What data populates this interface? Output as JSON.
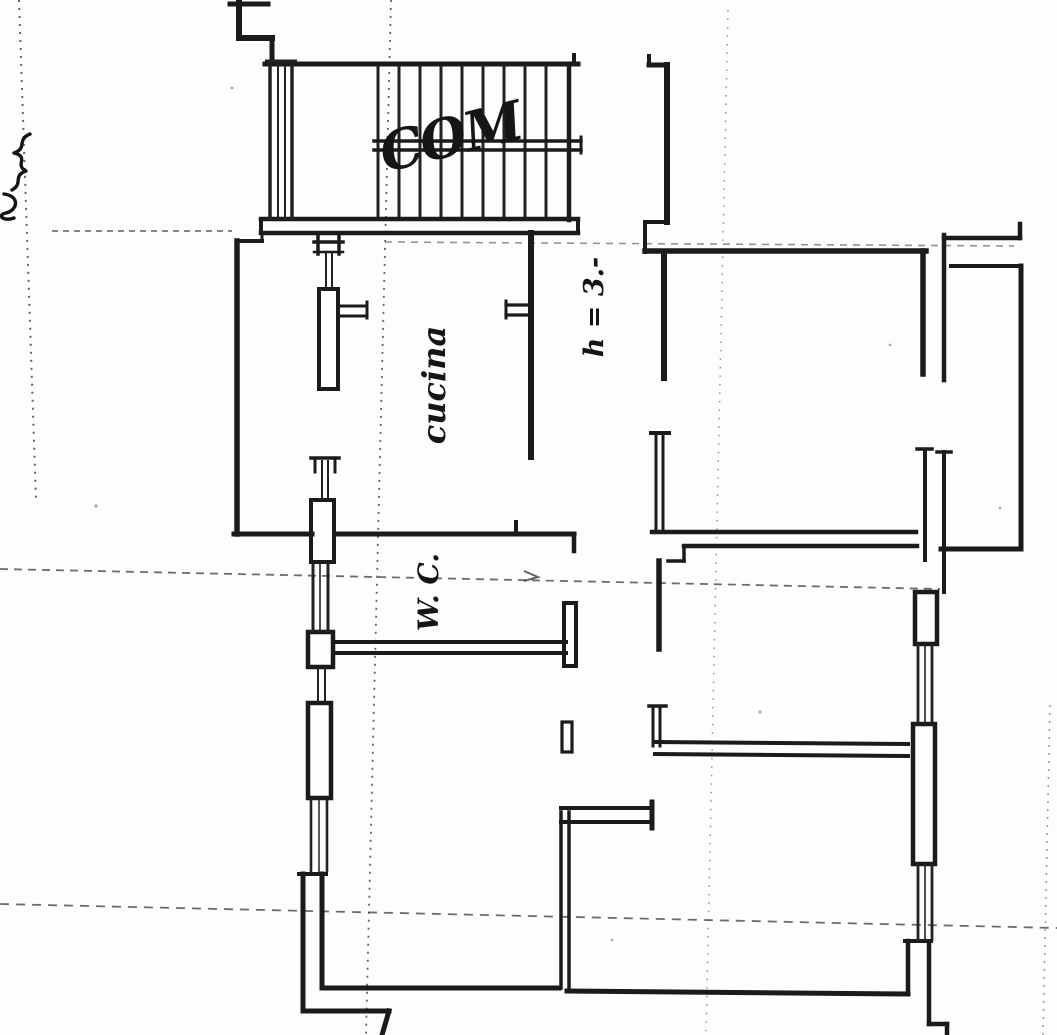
{
  "plan": {
    "labels": {
      "stairwell": "COM",
      "kitchen": "cucina",
      "height_note": "h = 3.-",
      "wc": "W. C."
    },
    "colors": {
      "paper": "#fdfdfb",
      "ink": "#1b1b1b",
      "guide_line": "#3c3c3c"
    }
  }
}
